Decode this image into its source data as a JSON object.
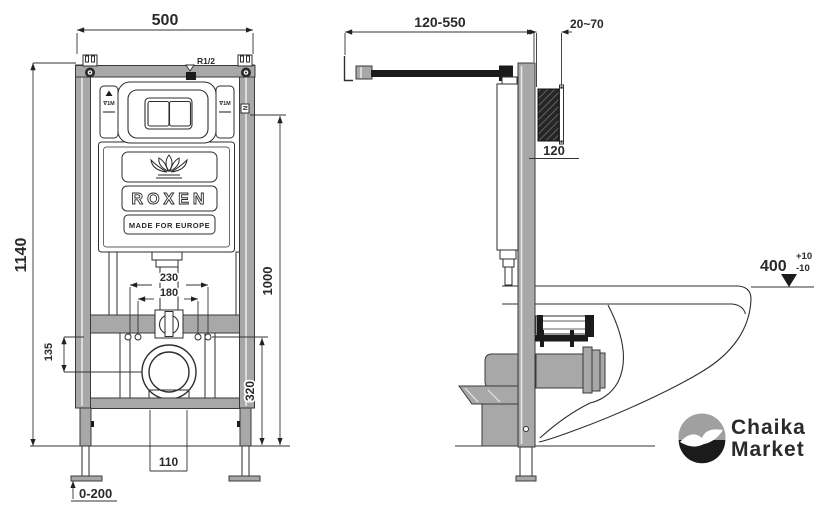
{
  "front_view": {
    "dim_width": "500",
    "dim_height": "1140",
    "dim_holes_outer": "230",
    "dim_holes_inner": "180",
    "dim_inlet_drop": "135",
    "dim_drain_height": "320",
    "dim_bracket_height": "1000",
    "dim_outlet_width": "110",
    "dim_leg_range": "0-200",
    "thread_label": "R1/2",
    "valve_label": "∇1M",
    "rail_label": "N"
  },
  "brand": {
    "name": "ROXEN",
    "tagline": "MADE FOR EUROPE",
    "emblem": "lotus-icon"
  },
  "side_view": {
    "dim_support_range": "120-550",
    "dim_wall_offset": "20~70",
    "dim_depth": "120",
    "rim_height": {
      "value": "400",
      "tol_plus": "+10",
      "tol_minus": "-10"
    }
  },
  "watermark": {
    "line1": "Chaika",
    "line2": "Market",
    "emblem": "seagull-icon"
  },
  "colors": {
    "line": "#2a2a2a",
    "metal": "#a8a8a8",
    "dark": "#1b1b1b",
    "paper": "#ffffff"
  }
}
